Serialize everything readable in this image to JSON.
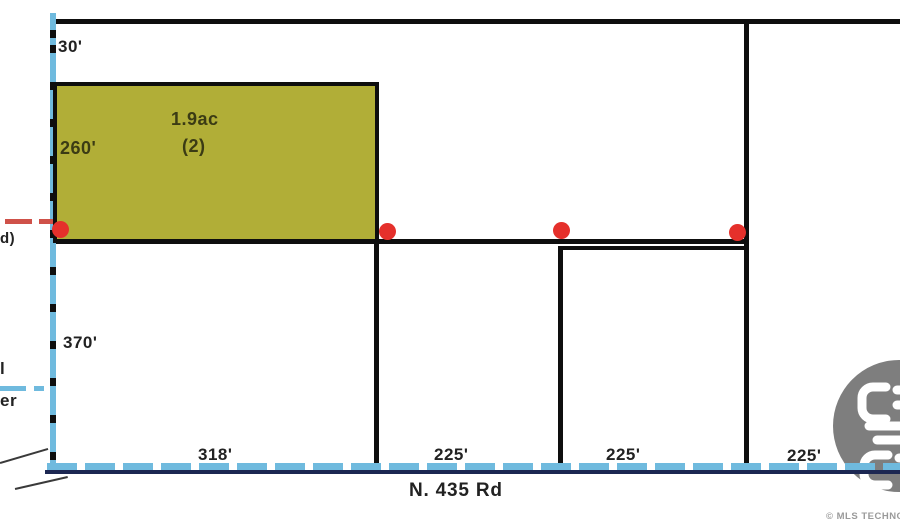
{
  "title": "Plat map — lots along N. 435 Rd",
  "colors": {
    "parcel_fill": "#b1ae37",
    "boundary_black": "#0e0e0e",
    "water_blue": "#6fbade",
    "road_navy": "#1c2752",
    "marker_red": "#e5302b",
    "dash_red": "#cf5149",
    "watermark_gray": "#7e7e7e",
    "label_dark": "#222222",
    "parcel_label_dark": "#3b3b14"
  },
  "highlighted_parcel": {
    "area": "1.9ac",
    "lot_number": "(2)"
  },
  "dimensions": {
    "north_strip_depth": "30'",
    "parcel2_depth": "260'",
    "south_depth": "370'",
    "lot1_frontage": "318'",
    "lot_frontages": [
      "225'",
      "225'",
      "225'"
    ]
  },
  "road": {
    "name": "N. 435 Rd"
  },
  "cut_labels": {
    "red_utility_fragment": "d)",
    "water_label_line1_fragment": "l",
    "water_label_line2_fragment": "er"
  },
  "watermark": {
    "copyright": "© MLS TECHNO"
  }
}
